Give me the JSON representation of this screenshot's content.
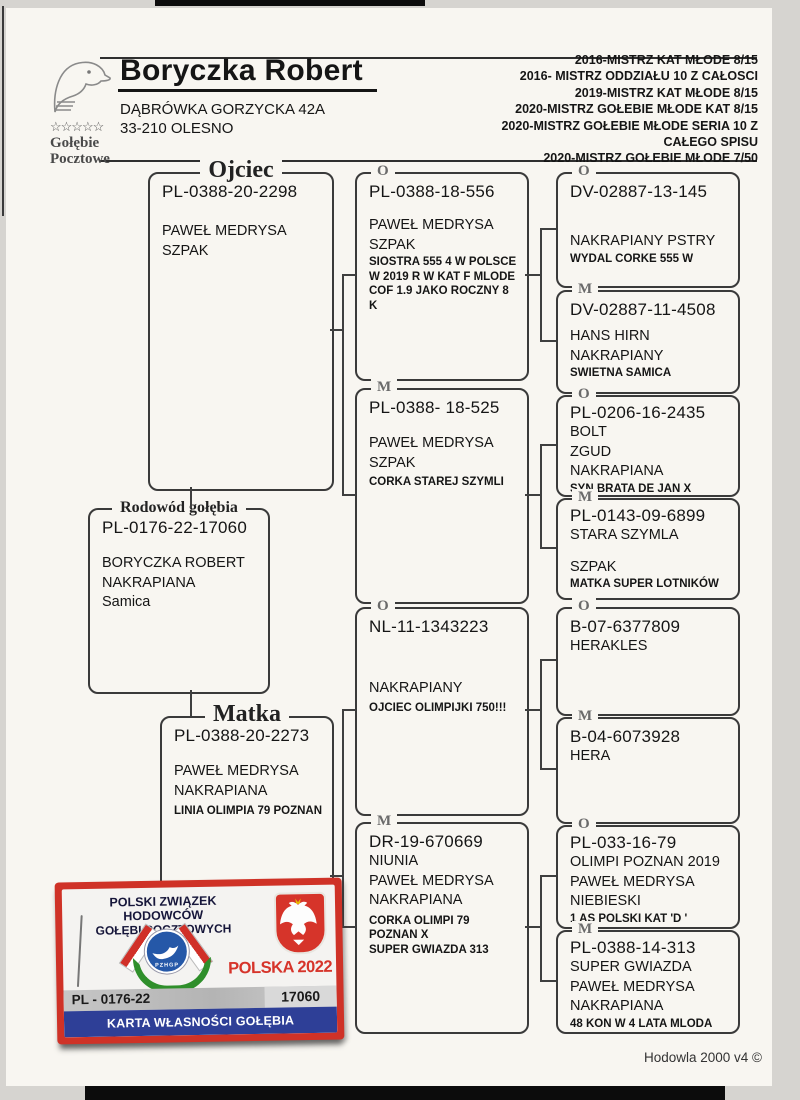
{
  "header": {
    "name": "Boryczka Robert",
    "address1": "DĄBRÓWKA GORZYCKA 42A",
    "address2": "33-210 OLESNO",
    "logo": {
      "stars": "☆☆☆☆☆",
      "line1": "Gołębie",
      "line2": "Pocztowe"
    },
    "achievements": [
      "2016-MISTRZ  KAT MŁODE 8/15",
      "2016- MISTRZ ODDZIAŁU 10 Z CAŁOSCI",
      "2019-MISTRZ  KAT MŁODE 8/15",
      "2020-MISTRZ GOŁEBIE MŁODE KAT 8/15",
      "2020-MISTRZ GOŁEBIE MŁODE SERIA 10 Z",
      "CAŁEGO SPISU",
      "2020-MISTRZ GOŁEBIE MŁODE 7/50"
    ]
  },
  "pedigree": {
    "subject": {
      "title": "Rodowód gołębia",
      "ring": "PL-0176-22-17060",
      "name1": "BORYCZKA ROBERT",
      "name2": "NAKRAPIANA",
      "name3": "Samica"
    },
    "father": {
      "title": "Ojciec",
      "ring": "PL-0388-20-2298",
      "name1": "PAWEŁ MEDRYSA",
      "name2": "SZPAK"
    },
    "mother": {
      "title": "Matka",
      "ring": "PL-0388-20-2273",
      "name1": "PAWEŁ MEDRYSA",
      "name2": "NAKRAPIANA",
      "note1": "LINIA OLIMPIA 79 POZNAN"
    },
    "gen2": [
      {
        "label": "O",
        "ring": "PL-0388-18-556",
        "name1": "PAWEŁ MEDRYSA",
        "name2": "SZPAK",
        "note1": "SIOSTRA 555 4 W POLSCE",
        "note2": "W 2019 R W KAT F MLODE",
        "note3": "COF 1.9   JAKO ROCZNY 8 K"
      },
      {
        "label": "M",
        "ring": "PL-0388- 18-525",
        "name1": "PAWEŁ MEDRYSA",
        "name2": "SZPAK",
        "note1": "CORKA STAREJ SZYMLI"
      },
      {
        "label": "O",
        "ring": "NL-11-1343223",
        "name1": "NAKRAPIANY",
        "note1": "OJCIEC OLIMPIJKI 750!!!"
      },
      {
        "label": "M",
        "ring": "DR-19-670669",
        "name1": "NIUNIA",
        "name2": "PAWEŁ MEDRYSA",
        "name3": "NAKRAPIANA",
        "note1": "CORKA OLIMPI 79 POZNAN X",
        "note2": "SUPER GWIAZDA 313"
      }
    ],
    "gen3": [
      {
        "label": "O",
        "ring": "DV-02887-13-145",
        "name1": "NAKRAPIANY PSTRY",
        "note1": "WYDAL CORKE  555 W"
      },
      {
        "label": "M",
        "ring": "DV-02887-11-4508",
        "name1": "HANS HIRN",
        "name2": "NAKRAPIANY",
        "note1": "SWIETNA SAMICA"
      },
      {
        "label": "O",
        "ring": "PL-0206-16-2435",
        "name1": "BOLT",
        "name2": "ZGUD",
        "name3": "NAKRAPIANA",
        "note1": "SYN BRATA DE JAN X"
      },
      {
        "label": "M",
        "ring": "PL-0143-09-6899",
        "name1": "STARA SZYMLA",
        "name2": "SZPAK",
        "note1": "MATKA SUPER LOTNIKÓW"
      },
      {
        "label": "O",
        "ring": "B-07-6377809",
        "name1": "HERAKLES"
      },
      {
        "label": "M",
        "ring": "B-04-6073928",
        "name1": "HERA"
      },
      {
        "label": "O",
        "ring": "PL-033-16-79",
        "name1": "OLIMPI POZNAN 2019",
        "name2": "PAWEŁ MEDRYSA",
        "name3": "NIEBIESKI",
        "note1": "1 AS POLSKI KAT 'D '"
      },
      {
        "label": "M",
        "ring": "PL-0388-14-313",
        "name1": "SUPER GWIAZDA",
        "name2": "PAWEŁ MEDRYSA",
        "name3": "NAKRAPIANA",
        "note1": "48 KON W 4 LATA MLODA"
      }
    ]
  },
  "card": {
    "org1": "POLSKI ZWIĄZEK HODOWCÓW",
    "org2": "GOŁĘBI POCZTOWYCH",
    "emblem_text": "PZHGP",
    "country_year": "POLSKA 2022",
    "ring_prefix": "PL - 0176-22",
    "ring_number": "17060",
    "card_title": "KARTA WŁASNOŚCI GOŁĘBIA POCZTOWEGO"
  },
  "footer": {
    "text": "Hodowla 2000 v4 ©"
  },
  "icons": {
    "header_logo": "pigeon-head-sketch",
    "card_eagle": "white-crowned-eagle",
    "card_emblem": "pzhgp-dove-badge"
  },
  "colors": {
    "card_red": "#cf3227",
    "card_blue": "#2e3f97",
    "laurel_green": "#2f8f2b",
    "circle_blue": "#2558a8"
  }
}
